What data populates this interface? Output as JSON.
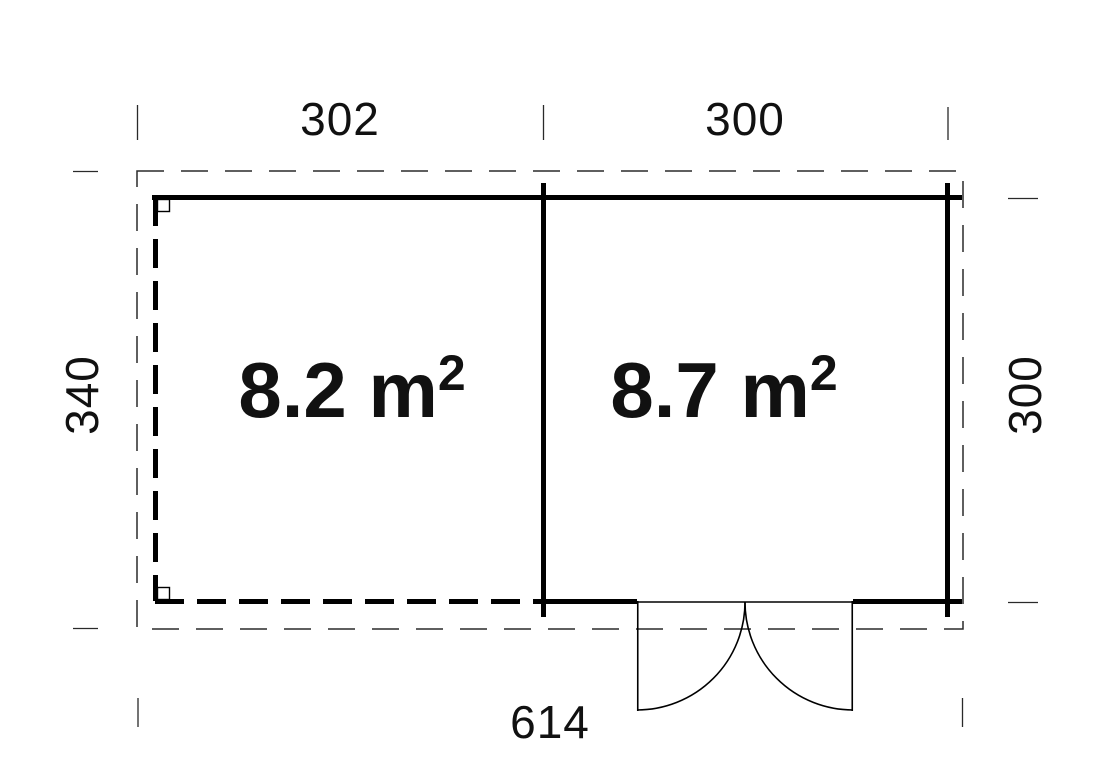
{
  "plan": {
    "type": "floor-plan",
    "colors": {
      "line": "#000000",
      "thin_line": "#2a2a2a",
      "background": "#ffffff",
      "text": "#111111"
    },
    "dimensions": {
      "top_left_width": "302",
      "top_right_width": "300",
      "left_height": "340",
      "right_height": "300",
      "bottom_total": "614"
    },
    "rooms": {
      "left": {
        "area": "8.2 m",
        "area_sup": "2"
      },
      "right": {
        "area": "8.7 m",
        "area_sup": "2"
      }
    }
  }
}
